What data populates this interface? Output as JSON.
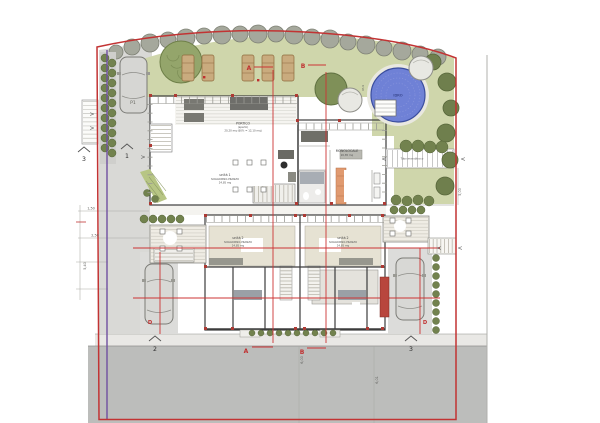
{
  "title": "totale 219,54 mq.",
  "colors": {
    "boundary_red": "#c23333",
    "parcel_purple": "#7050a0",
    "lawn_green": "#cfd6ab",
    "road_gray": "#bcbdbb",
    "pool_blue": "#6f81d6",
    "accent_red": "#ad3a34",
    "tree_green": "#6f7f4d"
  },
  "labels": {
    "parking": "P1",
    "pool": "IDRO",
    "portico_l1": "PORTICO",
    "portico_l2": "(aperto)",
    "portico_l3": "20,20 mq (60% = 12,10 mq)",
    "unit1_l1": "unità 1",
    "unit1_l2": "SOGGIORNO-PRANZO",
    "unit1_l3": "24,85 mq",
    "mono_l1": "MONOLOCALE",
    "mono_l2": "20,85 mq",
    "unit2_l1": "unità 2",
    "unit2_l2": "SOGGIORNO-PRANZO",
    "unit2_l3": "24,85 mq",
    "path_note": "Tubo monoblocco"
  },
  "sections": {
    "a": "A",
    "b": "B",
    "d": "D"
  },
  "views": {
    "v1": "1",
    "v2": "2",
    "v3": "3"
  },
  "dims": {
    "left_1": "1,50",
    "left_2": "2,50",
    "left_3": "5,40",
    "right_1": "5,00",
    "road_1": "6,00",
    "road_2": "6,01",
    "pool_spot": "97,9"
  },
  "arrows": {
    "left": "<",
    "right": ">"
  }
}
